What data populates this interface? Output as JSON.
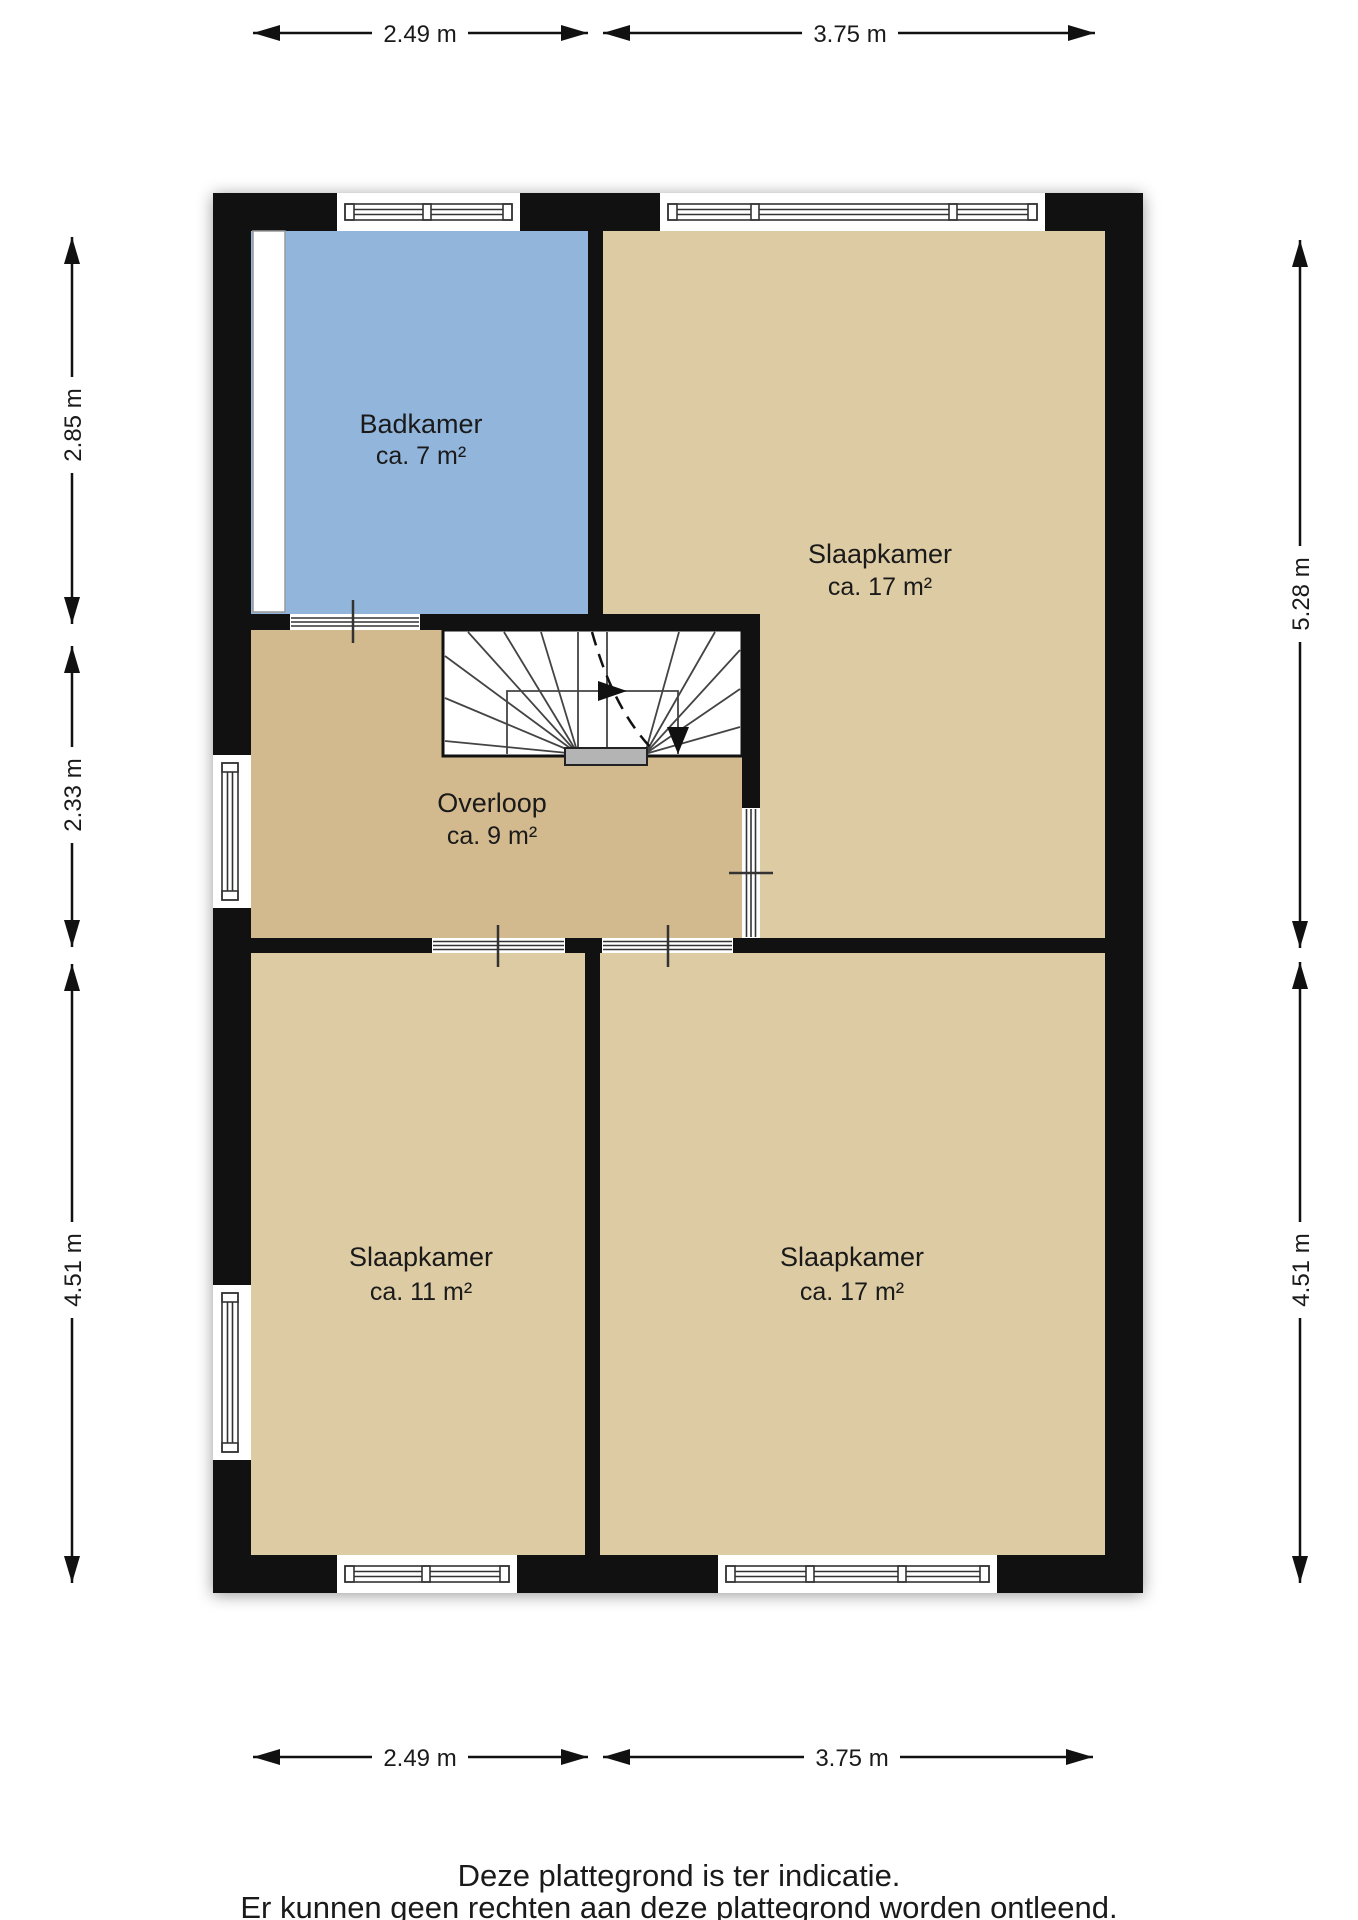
{
  "plan": {
    "rooms": [
      {
        "name": "Badkamer",
        "area": "ca. 7 m²",
        "color": "#92b5dc"
      },
      {
        "name": "Slaapkamer",
        "area": "ca. 17 m²",
        "color": "#ddcba3"
      },
      {
        "name": "Overloop",
        "area": "ca. 9 m²",
        "color": "#d3ba8e"
      },
      {
        "name": "Slaapkamer",
        "area": "ca. 11 m²",
        "color": "#ddcba3"
      },
      {
        "name": "Slaapkamer",
        "area": "ca. 17 m²",
        "color": "#ddcba3"
      }
    ],
    "wall_color": "#111111",
    "stair_step_color": "#b4b4b4"
  },
  "dimensions": {
    "top": [
      "2.49 m",
      "3.75 m"
    ],
    "bottom": [
      "2.49 m",
      "3.75 m"
    ],
    "left": [
      "2.85 m",
      "2.33 m",
      "4.51 m"
    ],
    "right": [
      "5.28 m",
      "4.51 m"
    ]
  },
  "footer": {
    "line1": "Deze plattegrond is ter indicatie.",
    "line2": "Er kunnen geen rechten aan deze plattegrond worden ontleend."
  }
}
